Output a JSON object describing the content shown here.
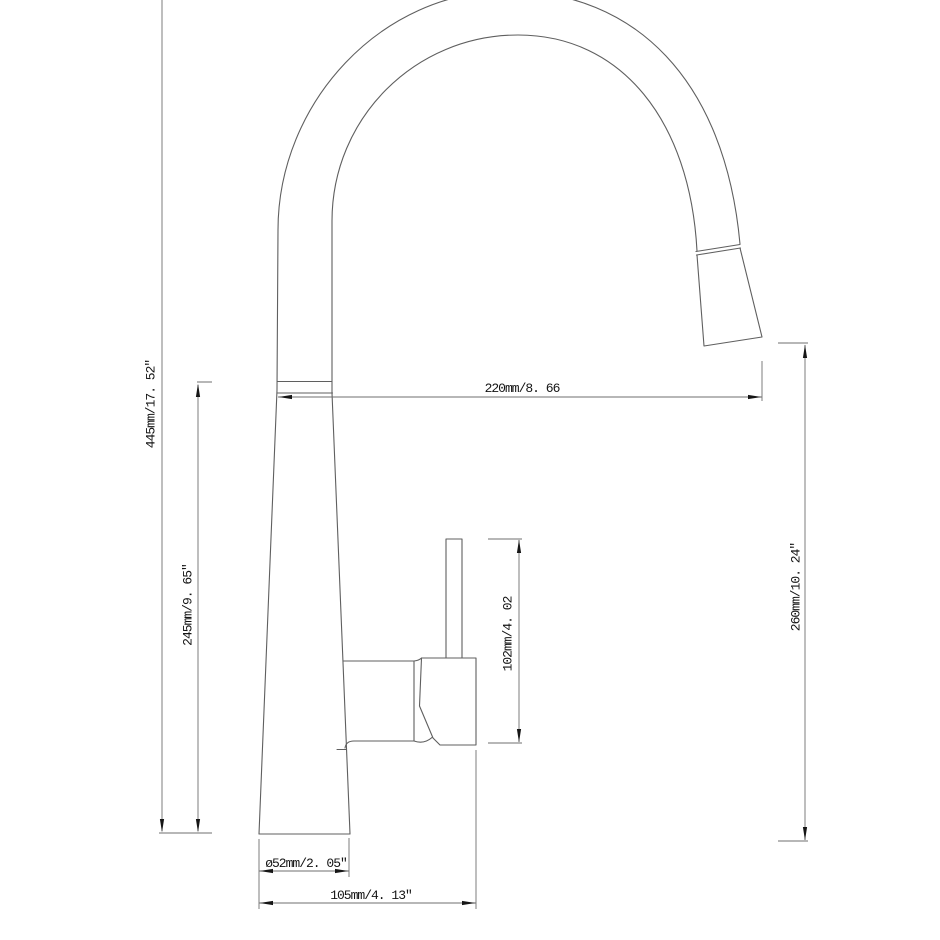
{
  "drawing": {
    "type": "technical-dimension-drawing",
    "subject": "pull-down kitchen faucet, side elevation",
    "colors": {
      "background": "#ffffff",
      "outline_line": "#5f5f5f",
      "dimension_line": "#6f6f6f",
      "arrow": "#161616",
      "text": "#141414"
    },
    "dimensions": {
      "overall_height": "445mm/17. 52″",
      "upper_body_height": "245mm/9. 65″",
      "spout_reach": "220mm/8. 66",
      "outlet_height": "260mm/10. 24″",
      "handle_height": "102mm/4. 02",
      "base_diameter": "ø52mm/2. 05″",
      "base_width": "105mm/4. 13″"
    }
  }
}
